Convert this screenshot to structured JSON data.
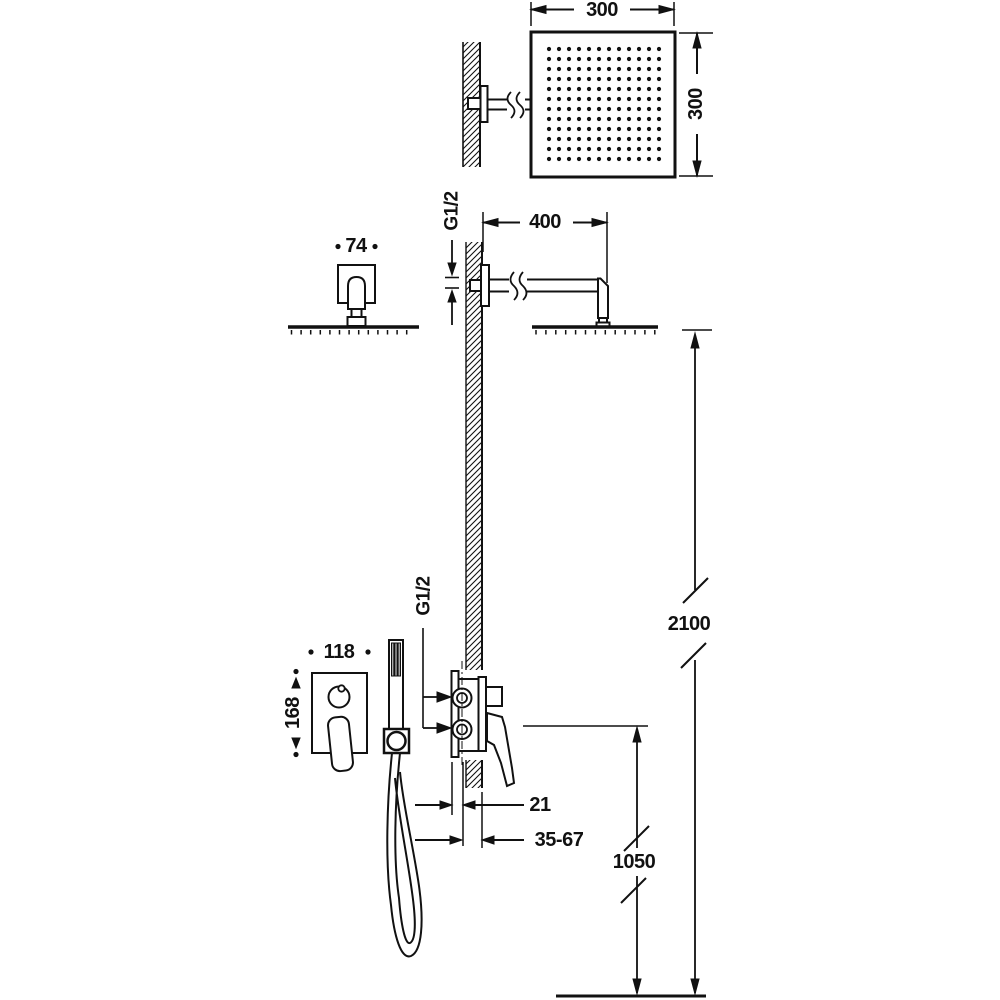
{
  "page": {
    "background": "#ffffff",
    "line_color": "#111111",
    "description_labels_visible_only": true
  },
  "labels": {
    "head_width": "300",
    "head_height": "300",
    "arm_escutcheon_width": "74",
    "arm_thread": "G1/2",
    "arm_length": "400",
    "head_height_from_floor": "2100",
    "trim_plate_width": "118",
    "trim_plate_height": "168",
    "valve_thread": "G1/2",
    "valve_wall_offset": "21",
    "install_depth_range": "35-67",
    "valve_height_from_floor": "1050"
  }
}
